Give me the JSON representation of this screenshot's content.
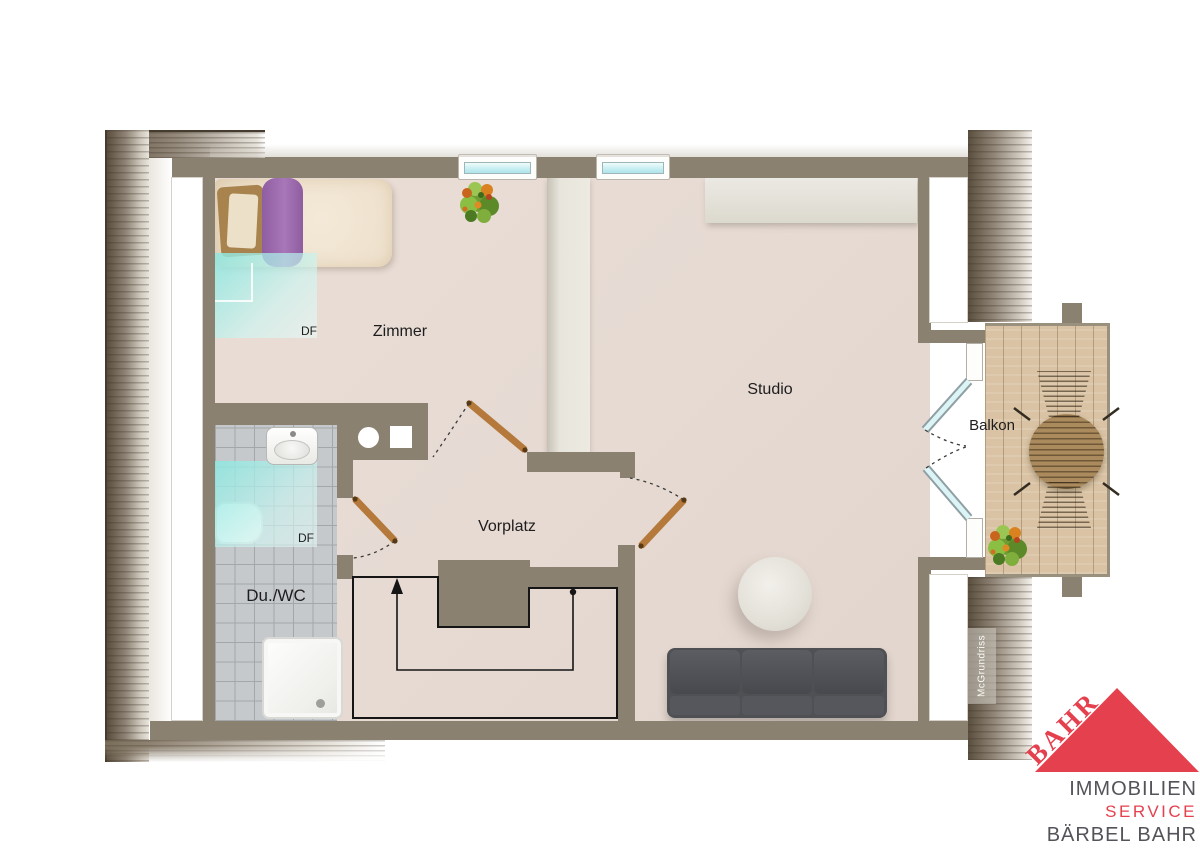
{
  "labels": {
    "zimmer": "Zimmer",
    "studio": "Studio",
    "vorplatz": "Vorplatz",
    "du_wc": "Du./WC",
    "balkon": "Balkon",
    "df_zimmer": "DF",
    "df_bad": "DF",
    "watermark": "McGrundriss"
  },
  "logo": {
    "brand": "BAHR",
    "line1": "IMMOBILIEN",
    "line2": "SERVICE",
    "line3": "BÄRBEL BAHR"
  },
  "colors": {
    "wall": "#8b8170",
    "floor": "#e6dad3",
    "tile": "#c6c9cc",
    "grout": "#a4a7aa",
    "skylight": "#9fe8e2",
    "window_glass": "#c9eff2",
    "wood_deck": "#d9c3a4",
    "rattan": "#ab8b5d",
    "sofa": "#4e5054",
    "door_leaf": "#b5793c",
    "stair_line": "#151515",
    "logo_red": "#e5404d",
    "logo_gray": "#53535a"
  }
}
